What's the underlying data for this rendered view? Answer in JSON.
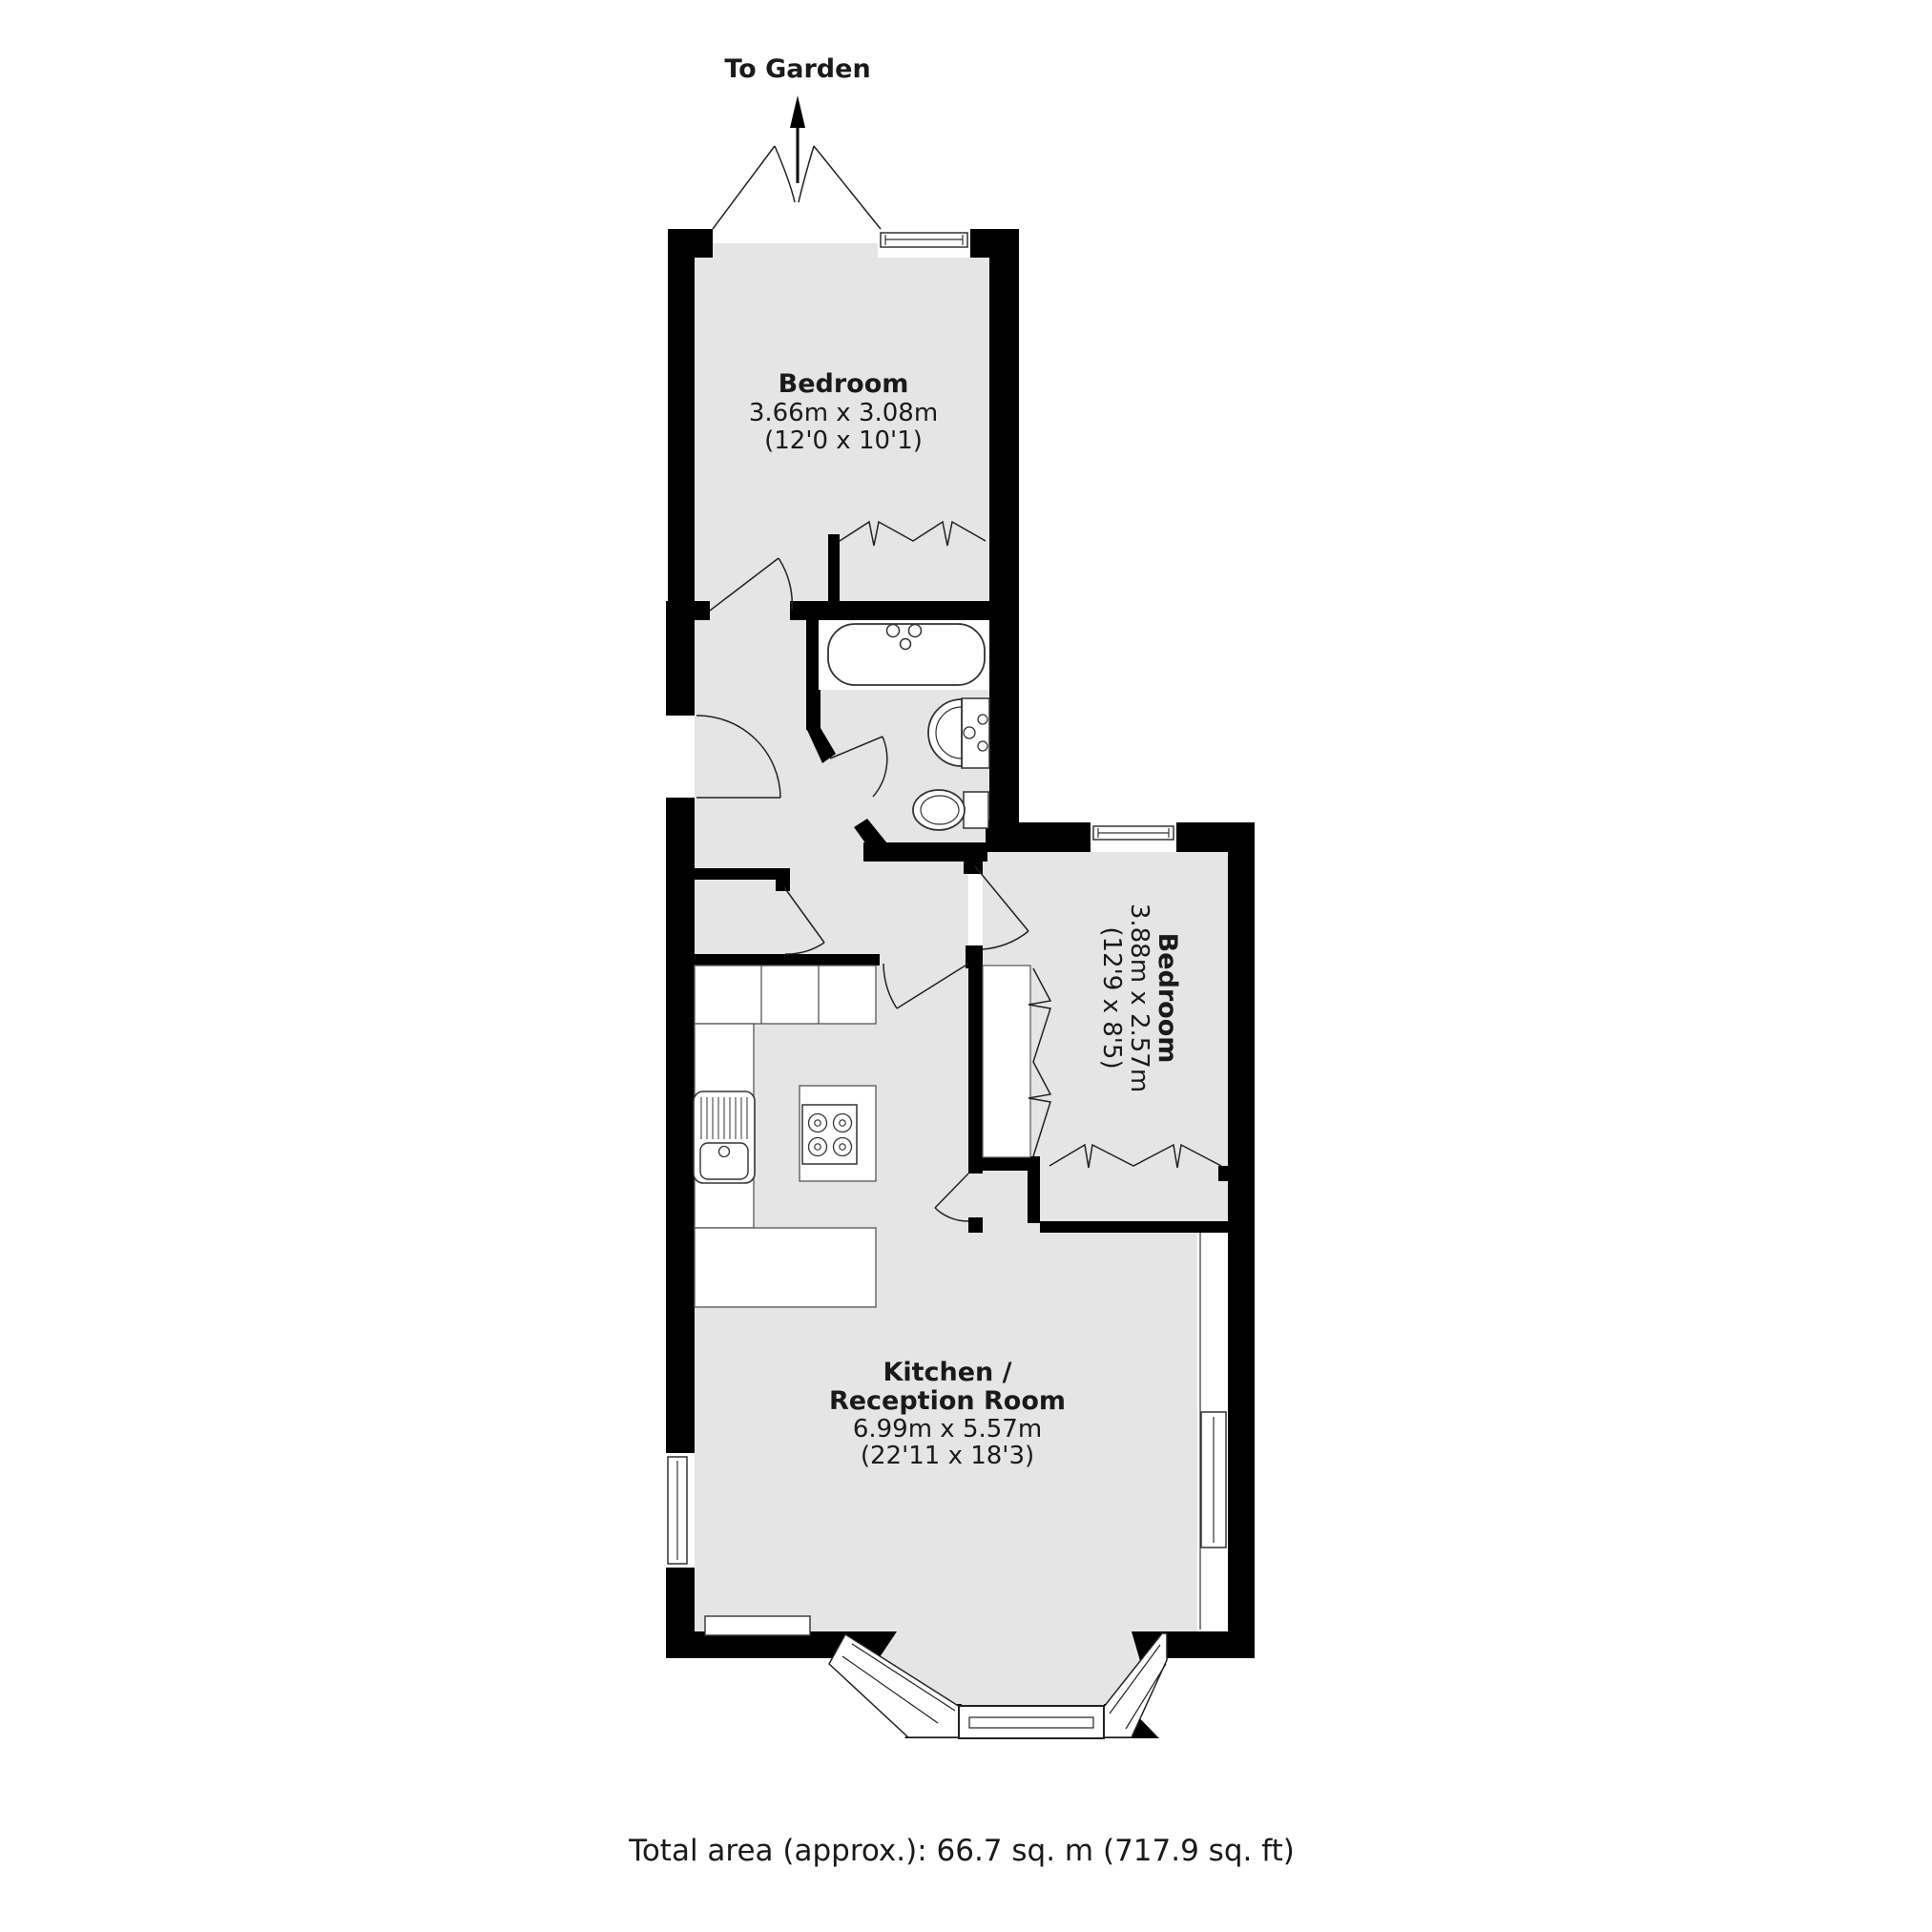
{
  "garden": {
    "label": "To Garden"
  },
  "rooms": {
    "bedroom1": {
      "name": "Bedroom",
      "size_metric": "3.66m x 3.08m",
      "size_imperial": "(12'0 x 10'1)"
    },
    "bedroom2": {
      "name": "Bedroom",
      "size_metric": "3.88m x 2.57m",
      "size_imperial": "(12'9 x 8'5)"
    },
    "kitchen": {
      "name_line1": "Kitchen /",
      "name_line2": "Reception Room",
      "size_metric": "6.99m x 5.57m",
      "size_imperial": "(22'11 x 18'3)"
    }
  },
  "footer": {
    "total_area": "Total area (approx.): 66.7 sq. m (717.9 sq. ft)"
  },
  "colors": {
    "wall": "#000000",
    "floor": "#e5e5e5",
    "outline": "#222222"
  }
}
